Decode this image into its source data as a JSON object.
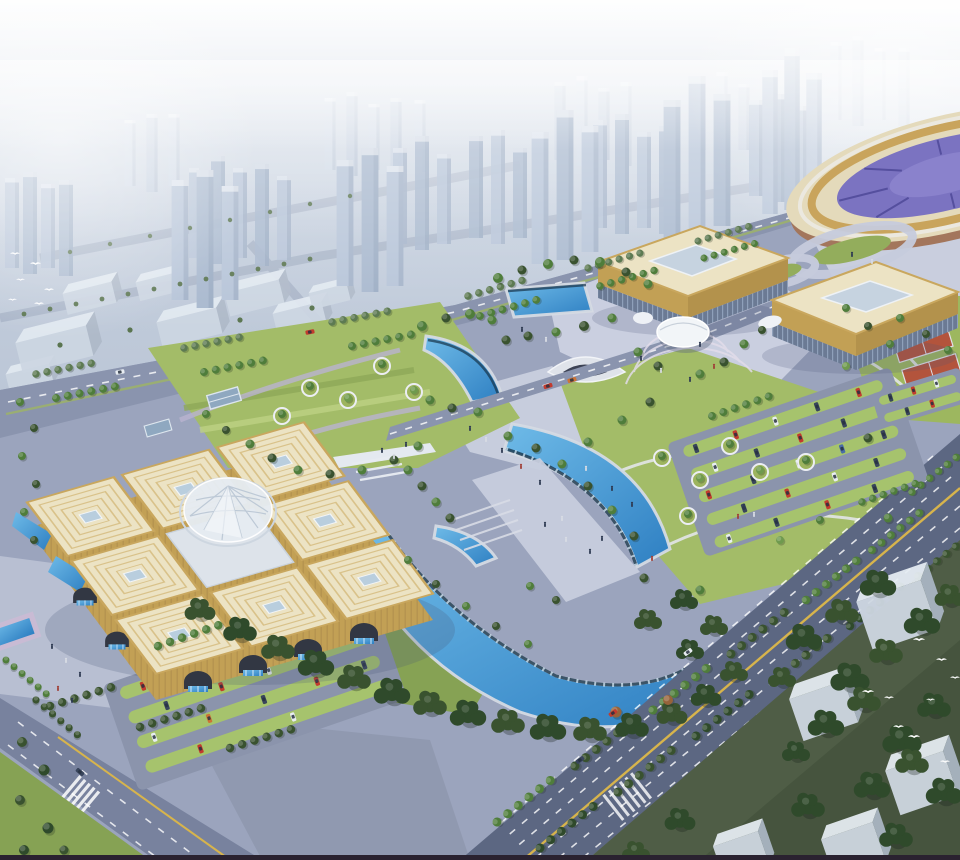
{
  "meta": {
    "domain": "Natural-Image",
    "type": "aerial-architectural-rendering",
    "description": "Bird's-eye architectural rendering of a civic exhibition campus: a golden nine-square pavilion exhibition center with central glass dome, two gold flat-roofed convention halls, an oval stadium at top right, crescent-shaped blue canals, landscaped parks with tree-lined paths, parking lots with cars, wide boulevards, white massing-model buildings and flying white birds, all set against a hazy high-rise city skyline fading into fog."
  },
  "scene": {
    "objects": [
      {
        "name": "city-skyline",
        "desc": "hazy translucent high-rise towers fading into fog"
      },
      {
        "name": "white-slab-buildings",
        "desc": "low translucent massing blocks in left midground"
      },
      {
        "name": "nw-road",
        "desc": "tree-lined arterial road separating city from campus"
      },
      {
        "name": "stadium",
        "desc": "oval stadium with cream roof ring, gold band and purple seating bowl"
      },
      {
        "name": "interchange",
        "desc": "looping lavender ramps with green islands in front of stadium"
      },
      {
        "name": "convention-hall-west",
        "desc": "gold flat-roofed hall with roof skylight and glass base"
      },
      {
        "name": "convention-hall-east",
        "desc": "gold flat-roofed hall with roof skylight and glass base"
      },
      {
        "name": "egg-pavilion",
        "desc": "small white shell-shaped pavilion on radial plaza"
      },
      {
        "name": "exhibition-center",
        "desc": "eight square golden pavilion roofs around a faceted glass dome, arched base with waterfalls"
      },
      {
        "name": "glass-dome",
        "desc": "central faceted glass dome of exhibition center"
      },
      {
        "name": "rect-pool",
        "desc": "rectangular reflecting pool north of central axis"
      },
      {
        "name": "lens-pool",
        "desc": "small lens-shaped pool west of axis"
      },
      {
        "name": "crescent-canal-north",
        "desc": "fan-shaped blue canal on upper plaza"
      },
      {
        "name": "crescent-canal-south",
        "desc": "large crescent blue canal sweeping through park"
      },
      {
        "name": "underpass",
        "desc": "white curved sunken-plaza entrance"
      },
      {
        "name": "central-plaza",
        "desc": "light paved pedestrian axis with steps and people"
      },
      {
        "name": "promenade",
        "desc": "walkway bridging the two crescent canals"
      },
      {
        "name": "nw-park",
        "desc": "striped lawn park with circular tree planters"
      },
      {
        "name": "central-park",
        "desc": "lawn with curved paths, circular planters and round plaza"
      },
      {
        "name": "east-lawn",
        "desc": "lawn with curved white paths beside stadium"
      },
      {
        "name": "sports-courts",
        "desc": "two red clay courts near east parking"
      },
      {
        "name": "west-parking",
        "desc": "parking rows with green stalls and cars"
      },
      {
        "name": "east-parking",
        "desc": "parking rows with green stalls and cars"
      },
      {
        "name": "stadium-parking",
        "desc": "small parking rows near courts"
      },
      {
        "name": "boulevard",
        "desc": "wide multi-lane road with yellow center line crossing bottom right"
      },
      {
        "name": "sw-road",
        "desc": "lane-marked road at bottom left with crosswalk"
      },
      {
        "name": "mid-road",
        "desc": "campus road with red cars between pools"
      },
      {
        "name": "reflecting-pool",
        "desc": "rectangular pool with lavender deck at left edge"
      },
      {
        "name": "tree-band",
        "desc": "dense tree belt along canal and boulevard"
      },
      {
        "name": "se-grove",
        "desc": "dark lawn with dense trees and white box buildings, bottom right"
      },
      {
        "name": "birds",
        "desc": "white gulls flying over left city and bottom-right grove"
      },
      {
        "name": "pedestrians",
        "desc": "tiny figures scattered on plazas"
      },
      {
        "name": "cars",
        "desc": "red, white, dark, blue and orange cars in lots and on roads"
      }
    ],
    "counts": {
      "pavilion-roofs": 8,
      "convention-halls": 2,
      "canal-segments": 4,
      "white-boxes": 5,
      "birds": 15
    }
  },
  "palette": {
    "sky_top": "#ccd6e3",
    "sky_bottom": "#a9b5c9",
    "fog": "#ffffff",
    "tower_light": "#c6d2e2",
    "tower_mid": "#b6c4d8",
    "tower_dark": "#a8b8ce",
    "plaza_base": "#9ba4bd",
    "plaza_light": "#c7cddd",
    "plaza_mid": "#b8bfd2",
    "plaza_shadow": "#8d95ad",
    "road_light": "#8a94ae",
    "road_dark": "#5c6782",
    "center_line_yellow": "#d7b44c",
    "lawn": "#a3bc68",
    "lawn_dark": "#86a254",
    "lawn_deep": "#4f5d46",
    "water_light": "#6fbbe8",
    "water_deep": "#2e7fc2",
    "pool_deck": "#c9bbd4",
    "roof_cream": "#ece3c4",
    "roof_gold_line": "#c9a75e",
    "gold_facade": "#c2a055",
    "gold_dark": "#a5854a",
    "glass_facade": "#6b7a94",
    "skylight_blue": "#b9cede",
    "dome_glass": "#e6ecf2",
    "stadium_roof": "#e4dabb",
    "stadium_bowl": "#7b73c1",
    "stadium_base": "#a3765c",
    "court_red": "#b3543c",
    "white_box_top": "#e6ecf2",
    "white_box_front": "#cfd8e2",
    "white_box_side": "#aab6c4",
    "bird_white": "#ffffff",
    "bottom_strip": "#2a2230"
  }
}
